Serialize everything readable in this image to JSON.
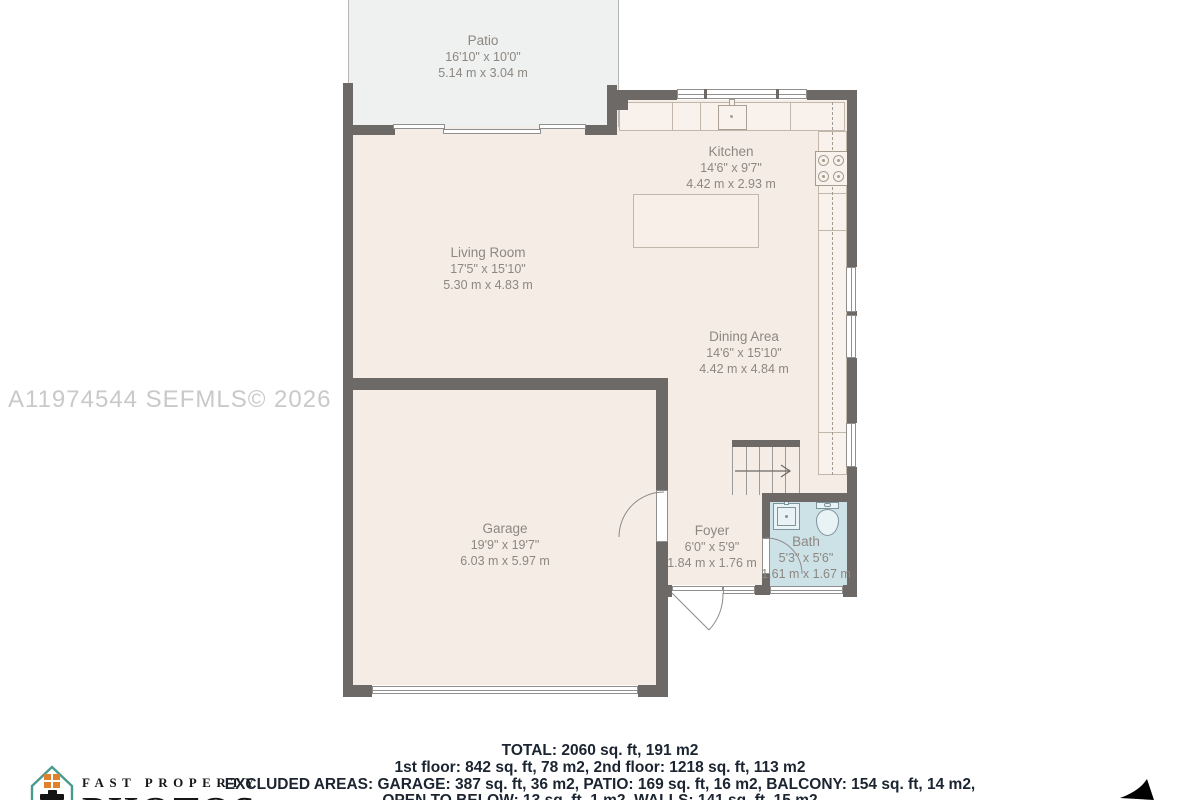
{
  "watermark": "A11974544  SEFMLS© 2026",
  "rooms": {
    "patio": {
      "name": "Patio",
      "imperial": "16'10\" x 10'0\"",
      "metric": "5.14 m x 3.04 m"
    },
    "kitchen": {
      "name": "Kitchen",
      "imperial": "14'6\" x 9'7\"",
      "metric": "4.42 m x 2.93 m"
    },
    "living_room": {
      "name": "Living Room",
      "imperial": "17'5\" x 15'10\"",
      "metric": "5.30 m x 4.83 m"
    },
    "dining_area": {
      "name": "Dining Area",
      "imperial": "14'6\" x 15'10\"",
      "metric": "4.42 m x 4.84 m"
    },
    "garage": {
      "name": "Garage",
      "imperial": "19'9\" x 19'7\"",
      "metric": "6.03 m x 5.97 m"
    },
    "foyer": {
      "name": "Foyer",
      "imperial": "6'0\" x 5'9\"",
      "metric": "1.84 m x 1.76 m"
    },
    "bath": {
      "name": "Bath",
      "imperial": "5'3\" x 5'6\"",
      "metric": "1.61 m x 1.67 m"
    }
  },
  "summary": {
    "total": "TOTAL: 2060 sq. ft, 191 m2",
    "floors": "1st floor: 842 sq. ft, 78 m2, 2nd floor: 1218 sq. ft, 113 m2",
    "excluded_line1": "EXCLUDED AREAS: GARAGE: 387 sq. ft, 36 m2, PATIO: 169 sq. ft, 16 m2, BALCONY: 154 sq. ft, 14 m2,",
    "excluded_line2": "OPEN TO BELOW: 13 sq. ft, 1 m2, WALLS: 141 sq. ft, 15 m2"
  },
  "branding": {
    "name_top": "FAST PROPERTY",
    "name_bottom": "PHOTOS"
  },
  "colors": {
    "wall": "#6d6966",
    "floor": "#f6ece6",
    "patio": "#eff0f0",
    "bath_floor": "#cde2e7",
    "logo_teal": "#489a8e",
    "logo_orange": "#e0812d",
    "summary_text": "#1b2430",
    "watermark_text": "#c9c9c9"
  }
}
